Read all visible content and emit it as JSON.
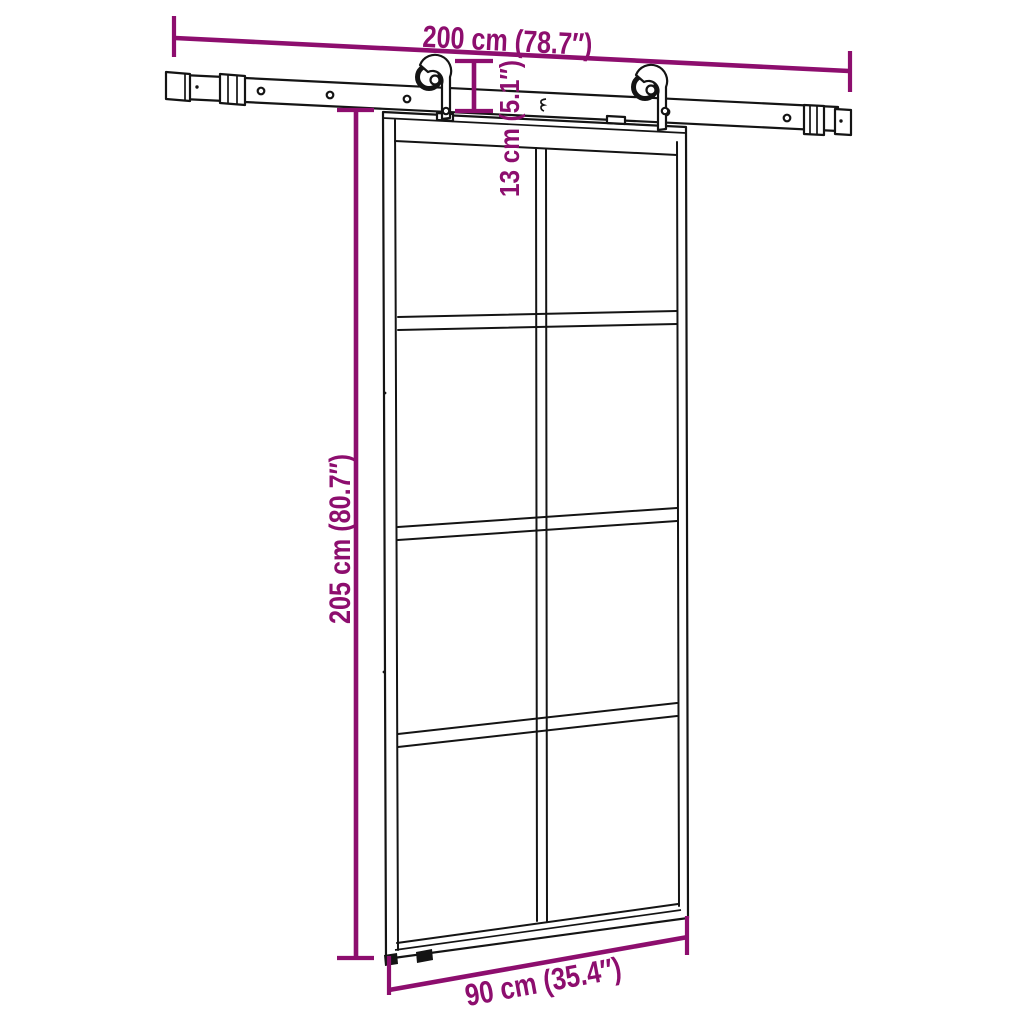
{
  "page": {
    "background": "#ffffff",
    "subject": "sliding-door-with-rail-dimension-diagram"
  },
  "colors": {
    "dimension_annotation": "#8D0E6E",
    "line_art": "#141414",
    "surface": "#ffffff"
  },
  "dimensions": {
    "rail_width": {
      "value_cm": 200,
      "value_inch": "78.7",
      "label": "200 cm (78.7″)"
    },
    "hardware_height": {
      "value_cm": 13,
      "value_inch": "5.1",
      "label": "13 cm (5.1″)"
    },
    "door_height": {
      "value_cm": 205,
      "value_inch": "80.7",
      "label": "205 cm (80.7″)"
    },
    "door_width": {
      "value_cm": 90,
      "value_inch": "35.4",
      "label": "90 cm (35.4″)"
    }
  },
  "components": {
    "rail": "overhead sliding rail with end stoppers and wall spacers",
    "door": "glass sliding door, 2 columns x 4 rows of panes",
    "hangers": "two roller hangers on straps"
  }
}
